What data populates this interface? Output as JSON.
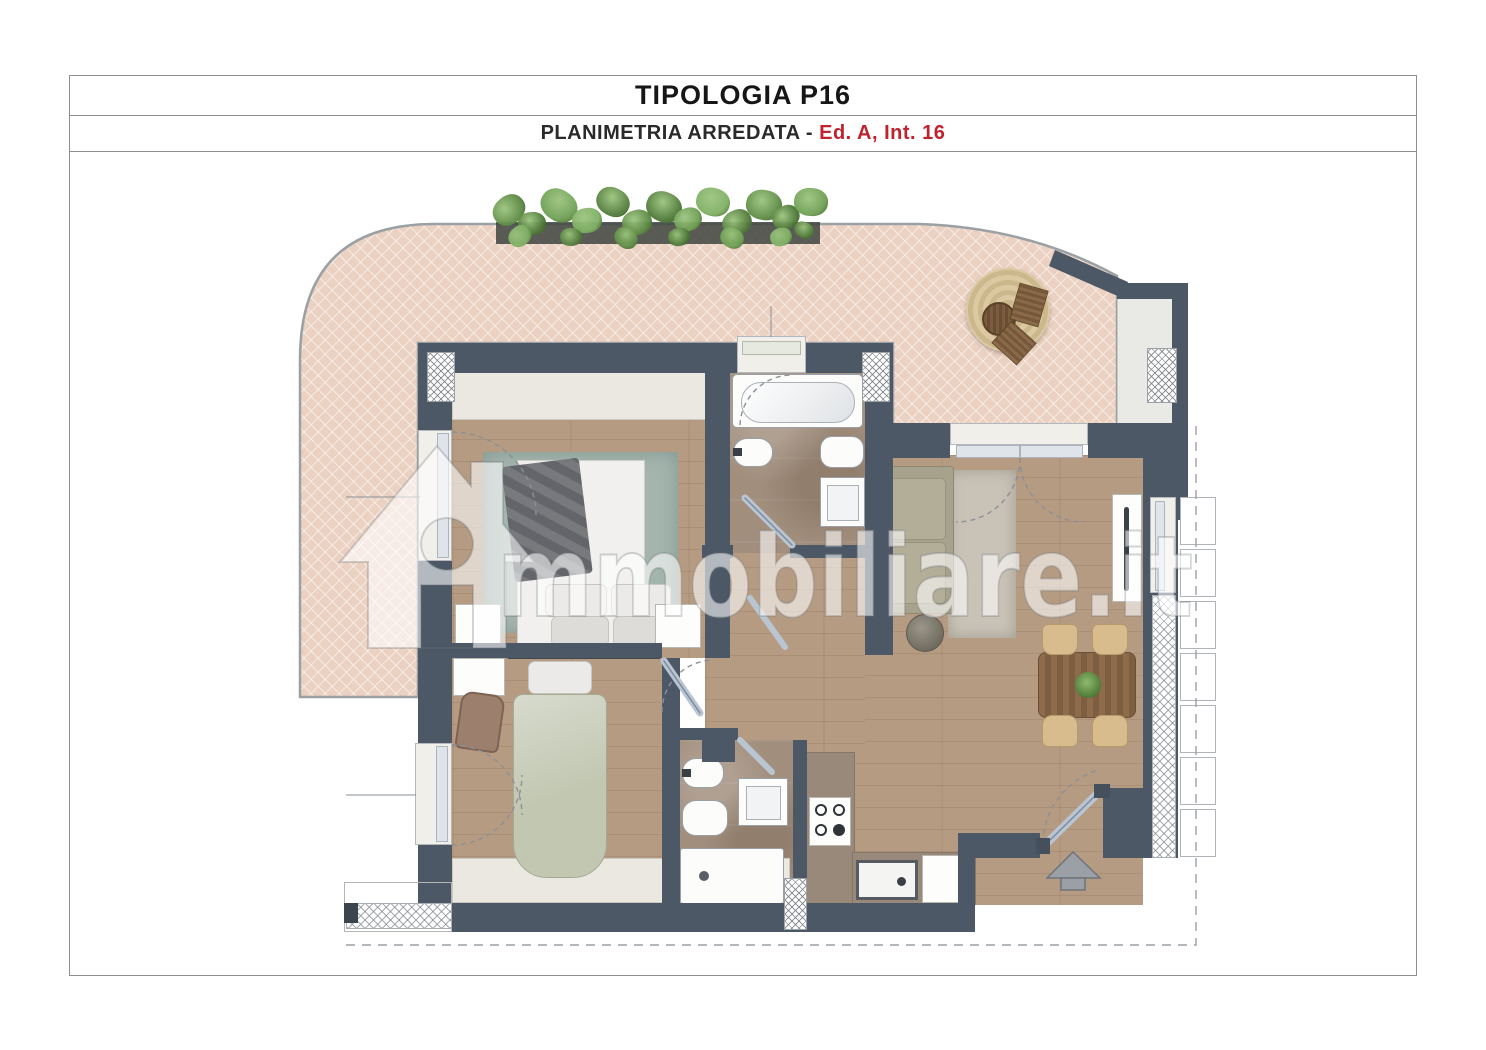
{
  "header": {
    "title": "TIPOLOGIA P16",
    "subtitle_prefix": "PLANIMETRIA ARREDATA - ",
    "subtitle_highlight": "Ed. A, Int. 16"
  },
  "watermark": {
    "brand_text": "mmobiliare.it",
    "icon": "immobiliare-house-icon"
  },
  "colors": {
    "accent_red": "#c0232e",
    "wall": "#4c5866",
    "terrace_tile": "#ebd1c1",
    "outline_gray": "#9aa0a4",
    "wood_floor": "#b69b83",
    "bath_tile": "#a18e7d",
    "kitchen_counter": "#99897a",
    "teal_rug": "#a4b5ae",
    "light_rug": "#c9c2b7",
    "sofa": "#a6a28c",
    "dining_table": "#8d6b4b",
    "chair_tan": "#d8bc8e",
    "jute_rug": "#dcc9a2",
    "plant_green": "#5e8a47",
    "watermark_fill": "rgba(255,255,255,0.58)"
  }
}
